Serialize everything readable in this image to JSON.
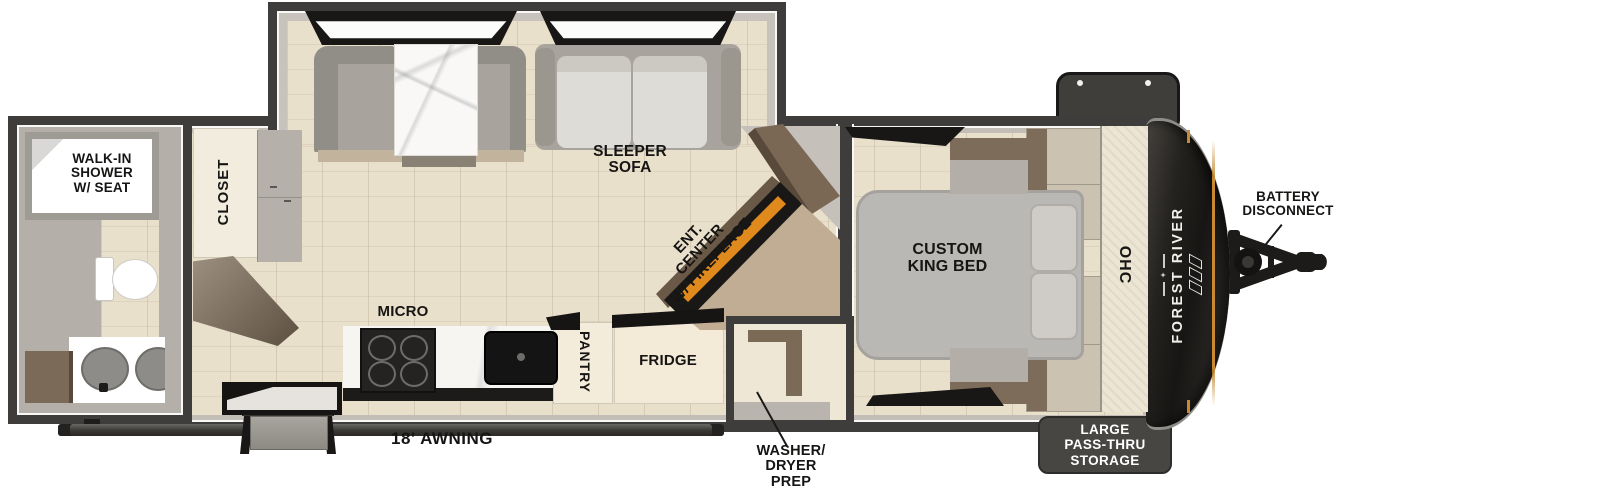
{
  "title": "Travel trailer floorplan",
  "brand": {
    "name": "FOREST RIVER"
  },
  "labels": {
    "shower": "WALK-IN\nSHOWER\nW/ SEAT",
    "closet": "CLOSET",
    "sleeper_sofa": "SLEEPER\nSOFA",
    "ent_center": "ENT.\nCENTER\nW/ FIREPLACE",
    "micro": "MICRO",
    "pantry": "PANTRY",
    "fridge": "FRIDGE",
    "washer_dryer_prep": "WASHER/\nDRYER\nPREP",
    "custom_king_bed": "CUSTOM\nKING BED",
    "ohc": "OHC",
    "battery_disconnect": "BATTERY\nDISCONNECT",
    "pass_thru_storage": "LARGE\nPASS-THRU\nSTORAGE",
    "awning": "18' AWNING"
  },
  "colors": {
    "wall": "#3f3d3b",
    "floor_wood": "#e9e0cc",
    "interior_gray": "#c2beb7",
    "cap_dark": "#1b1a18",
    "accent_orange": "#c78a33",
    "fireplace_glow": "#e08a1e",
    "storage_box": "#484643",
    "label_text": "#161514"
  }
}
